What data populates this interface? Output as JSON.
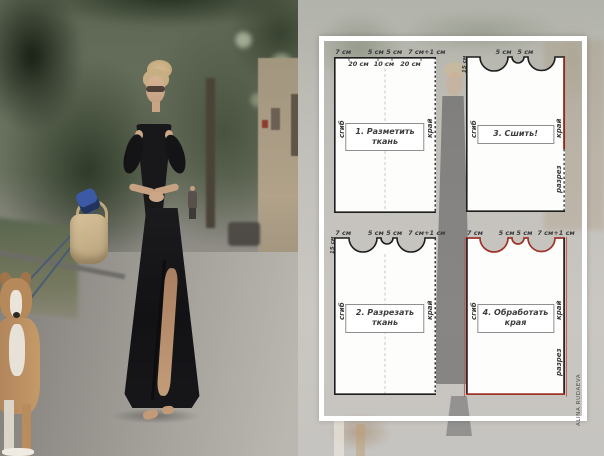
{
  "watermark": "ALINA RUDAEVA",
  "colors": {
    "edge_black": "#1d1d1d",
    "edge_red": "#9e3328",
    "frame_white": "#ffffff",
    "panel_fill": "#fdfdfc"
  },
  "panels": {
    "panel1": {
      "title_line1": "1. Разметить",
      "title_line2": "ткань",
      "top_labels": [
        "7 см",
        "5 см",
        "5 см",
        "7 см+1 см"
      ],
      "inner_labels": [
        "20 см",
        "10 см",
        "20 см"
      ],
      "left_label": "сгиб",
      "right_label": "край"
    },
    "panel2": {
      "title_line1": "2. Разрезать",
      "title_line2": "ткань",
      "top_labels": [
        "7 см",
        "5 см",
        "5 см",
        "7 см+1 см"
      ],
      "depth_label": "15 см",
      "left_label": "сгиб",
      "right_label": "край"
    },
    "panel3": {
      "title_line1": "3. Сшить!",
      "top_labels": [
        "5 см",
        "5 см"
      ],
      "depth_label": "15 см",
      "left_label": "сгиб",
      "right_label": "край",
      "slit_label": "разрез"
    },
    "panel4": {
      "title_line1": "4. Обработать",
      "title_line2": "края",
      "top_labels": [
        "7 см",
        "5 см",
        "5 см",
        "7 см+1 см"
      ],
      "left_label": "сгиб",
      "right_label": "край",
      "slit_label": "разрез"
    }
  }
}
